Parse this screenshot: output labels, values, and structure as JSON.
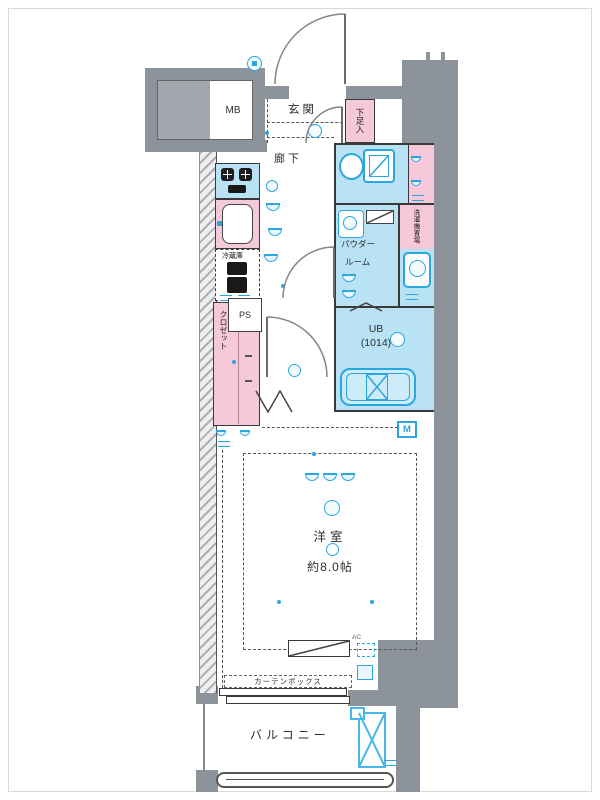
{
  "floorplan": {
    "labels": {
      "meter_box": "MB",
      "entrance": "玄関",
      "shoe_cabinet": "下足入",
      "hallway": "廊下",
      "refrigerator": "冷蔵庫",
      "powder_room_line1": "パウダー",
      "powder_room_line2": "ルーム",
      "laundry_space": "洗濯機置場",
      "pipe_space": "PS",
      "closet": "クロゼット",
      "unit_bath": "UB",
      "unit_bath_size": "(1014)",
      "meter": "M",
      "western_room": "洋室",
      "western_room_size": "約8.0帖",
      "air_conditioner": "AC",
      "curtain_box": "カーテンボックス",
      "balcony": "バルコニー"
    },
    "colors": {
      "wall_gray": "#8d939b",
      "wet_area_fill": "#b9e2f5",
      "fixture_blue": "#2aa7e0",
      "furniture_pink": "#f6c9da",
      "outline_dark": "#3a3a3a"
    }
  }
}
